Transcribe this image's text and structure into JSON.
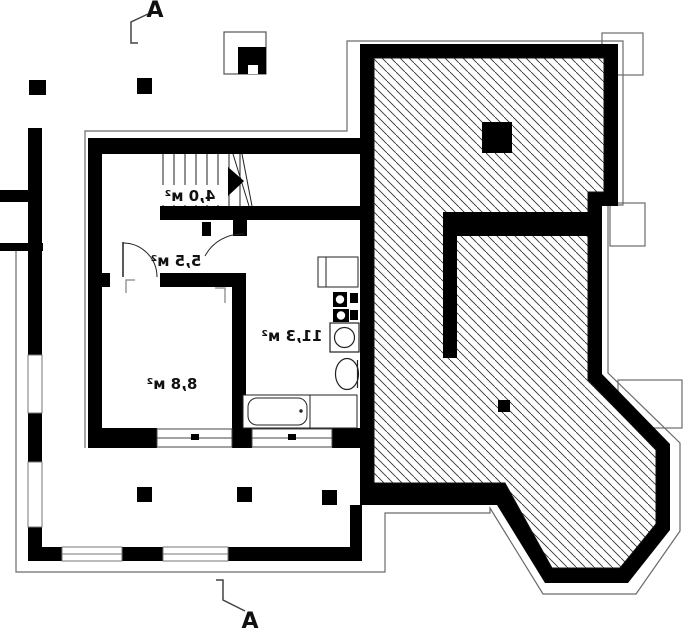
{
  "title": "Basement floor plan",
  "section_markers": {
    "top": "A",
    "bottom": "A"
  },
  "rooms": {
    "staircase": {
      "area_label": "4,0 м²"
    },
    "hallway": {
      "area_label": "5,5 м²"
    },
    "room": {
      "area_label": "8,8 м²"
    },
    "utility": {
      "area_label": "11,3 м²"
    }
  },
  "colors": {
    "walls": "#000000",
    "hatch_lines": "#333333",
    "thin_outline": "#6b6b6b",
    "paper": "#ffffff"
  }
}
